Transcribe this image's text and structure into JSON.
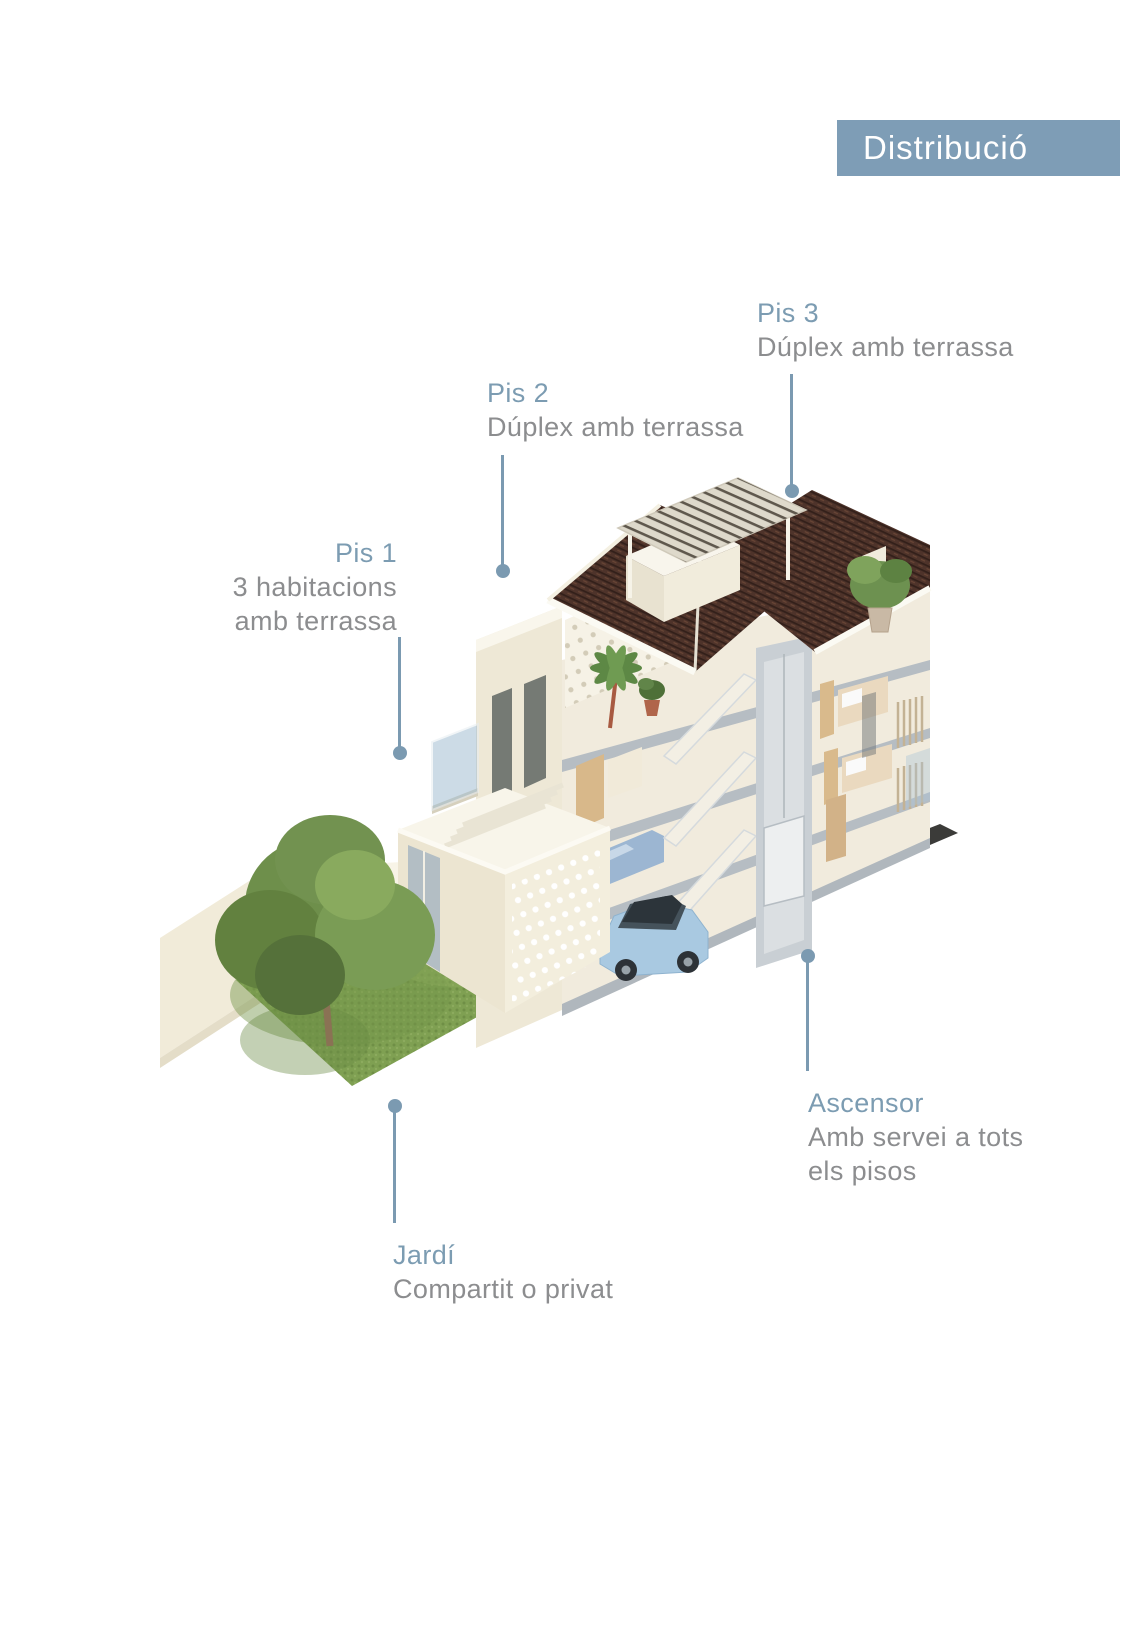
{
  "header": {
    "title": "Distribució"
  },
  "colors": {
    "page_bg": "#ffffff",
    "header_bg": "#7e9db6",
    "header_text": "#ffffff",
    "label_accent": "#7c9cb2",
    "label_text": "#8c8d8f",
    "leader": "#7b9ab1"
  },
  "annotations": {
    "pis3": {
      "title": "Pis 3",
      "line1": "Dúplex amb terrassa"
    },
    "pis2": {
      "title": "Pis 2",
      "line1": "Dúplex amb terrassa"
    },
    "pis1": {
      "title": "Pis 1",
      "line1": "3 habitacions",
      "line2": "amb terrassa"
    },
    "ascensor": {
      "title": "Ascensor",
      "line1": "Amb servei a tots",
      "line2": "els pisos"
    },
    "jardi": {
      "title": "Jardí",
      "line1": "Compartit o privat"
    }
  }
}
